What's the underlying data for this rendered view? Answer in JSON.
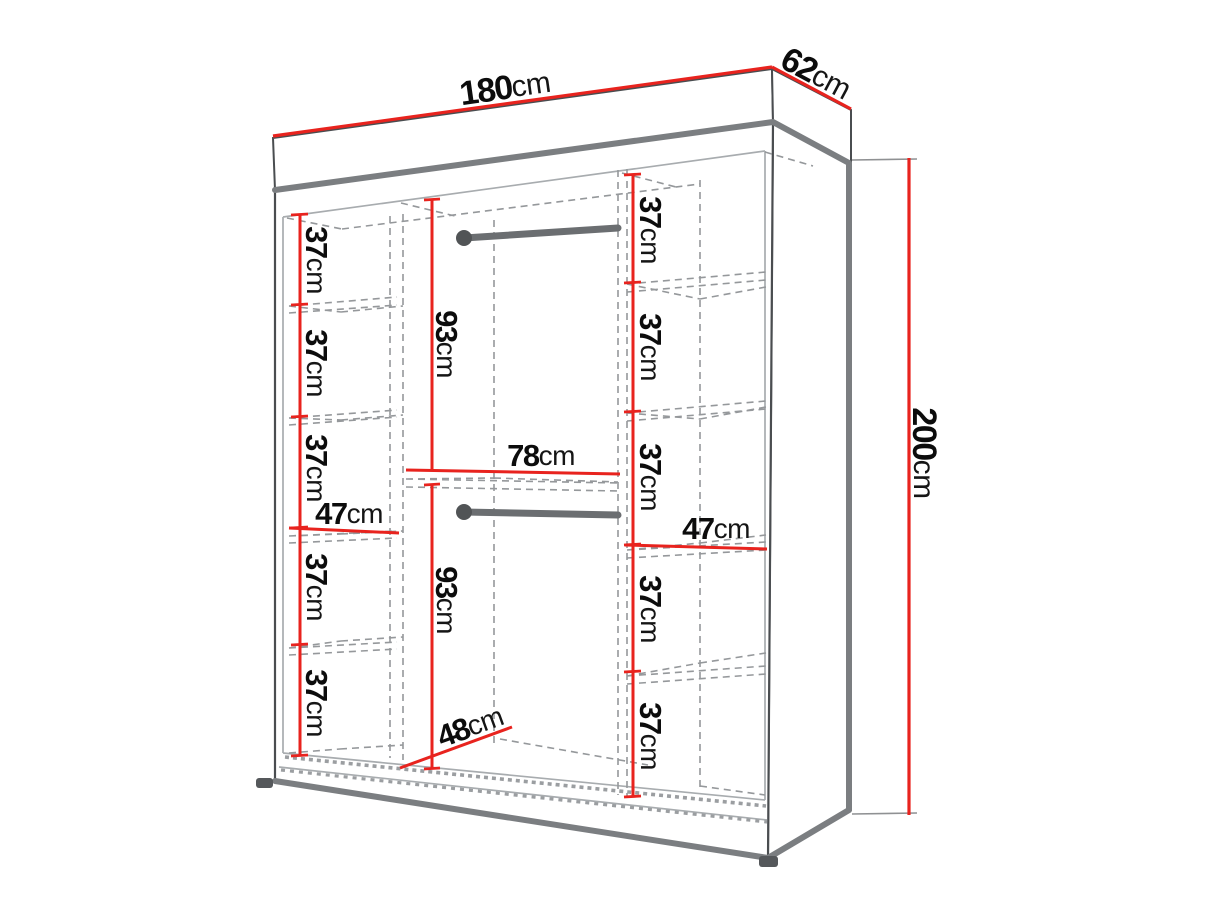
{
  "diagram": {
    "type": "furniture-dimension-diagram",
    "subject": "wardrobe interior dimensions, two-point perspective line drawing",
    "colors": {
      "dimension_red": "#e8231e",
      "cabinet_edge": "#4a4d50",
      "thick_edge": "#7b7e81",
      "inner_line": "#a8acaf",
      "dashed_line": "#95989b",
      "rail_gray": "#6b6e71",
      "label_text": "#0c0c0c",
      "background": "#ffffff"
    },
    "overall": {
      "width": {
        "value": "180",
        "unit": "cm"
      },
      "depth": {
        "value": "62",
        "unit": "cm"
      },
      "height": {
        "value": "200",
        "unit": "cm"
      }
    },
    "left_column": {
      "width": {
        "value": "47",
        "unit": "cm"
      },
      "gaps": [
        {
          "value": "37",
          "unit": "cm"
        },
        {
          "value": "37",
          "unit": "cm"
        },
        {
          "value": "37",
          "unit": "cm"
        },
        {
          "value": "37",
          "unit": "cm"
        },
        {
          "value": "37",
          "unit": "cm"
        }
      ]
    },
    "middle": {
      "width": {
        "value": "78",
        "unit": "cm"
      },
      "upper_hanging": {
        "value": "93",
        "unit": "cm"
      },
      "lower_hanging": {
        "value": "93",
        "unit": "cm"
      },
      "floor_depth": {
        "value": "48",
        "unit": "cm"
      }
    },
    "right_column": {
      "width": {
        "value": "47",
        "unit": "cm"
      },
      "gaps": [
        {
          "value": "37",
          "unit": "cm"
        },
        {
          "value": "37",
          "unit": "cm"
        },
        {
          "value": "37",
          "unit": "cm"
        },
        {
          "value": "37",
          "unit": "cm"
        },
        {
          "value": "37",
          "unit": "cm"
        }
      ]
    }
  }
}
